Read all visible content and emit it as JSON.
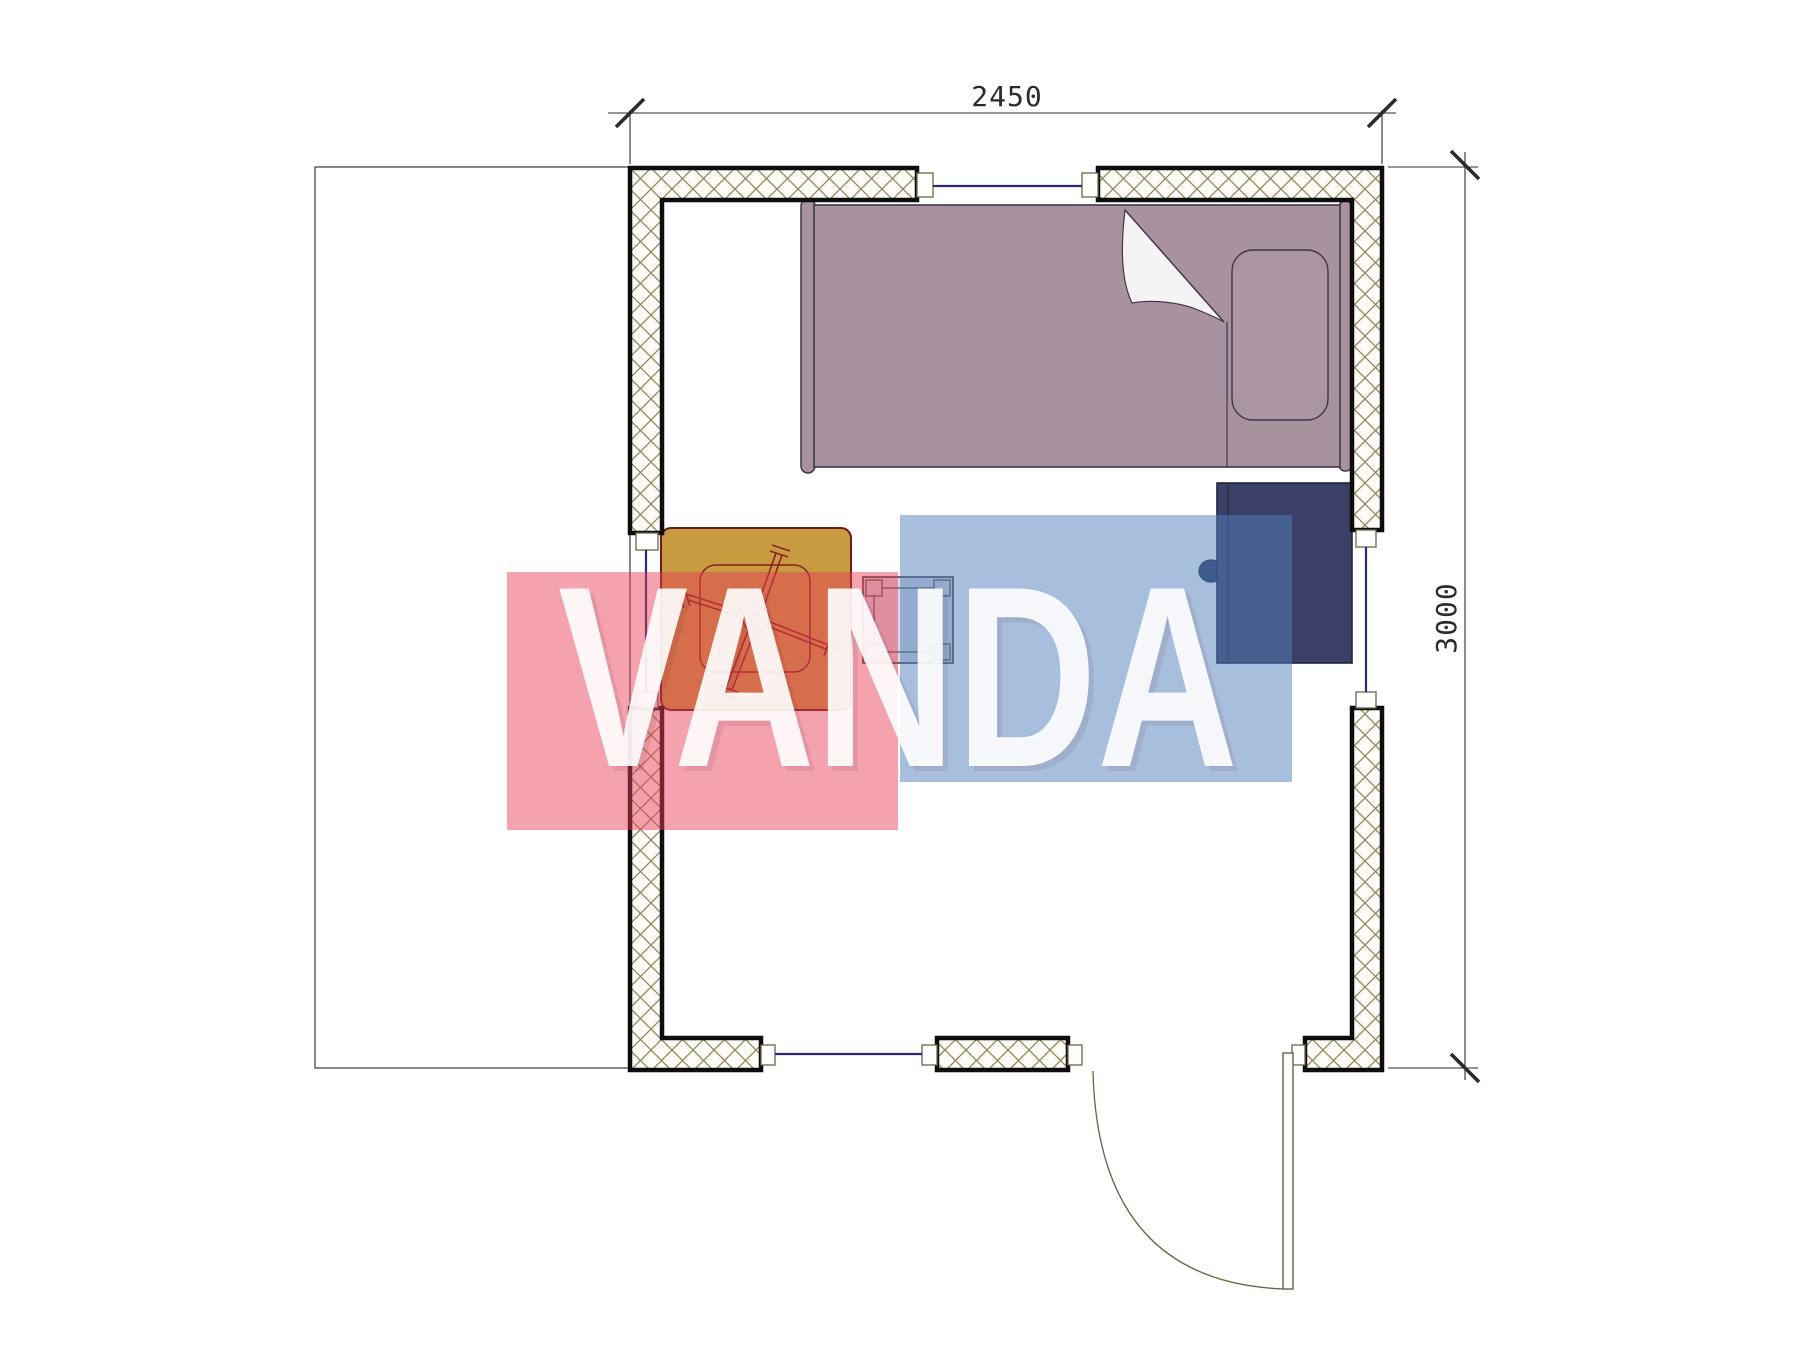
{
  "drawing": {
    "type": "floor-plan",
    "title": "cabin room plan",
    "dimensions": {
      "top_label": "2450",
      "right_label": "3000"
    },
    "room": {
      "width_mm": 2450,
      "depth_mm": 3000,
      "windows": 4,
      "doors": 1
    },
    "furniture": [
      {
        "name": "single-bed",
        "color": "#a8929e"
      },
      {
        "name": "pillow",
        "color": "#ab95a1"
      },
      {
        "name": "folding-table",
        "color": "#c89b41"
      },
      {
        "name": "stool",
        "color": "#8d99b5"
      },
      {
        "name": "cabinet",
        "color": "#3b4166"
      }
    ],
    "line_colors": {
      "wall_border": "#0d0d0d",
      "wall_hatch": "#93865c",
      "window_glass": "#2a2a7a",
      "dimension": "#2b2b2b",
      "door": "#6b6045"
    }
  },
  "watermark": {
    "text": "VANDA",
    "red_block_color": "#e93c55",
    "blue_block_color": "#5080b9",
    "text_color": "#ffffff"
  }
}
